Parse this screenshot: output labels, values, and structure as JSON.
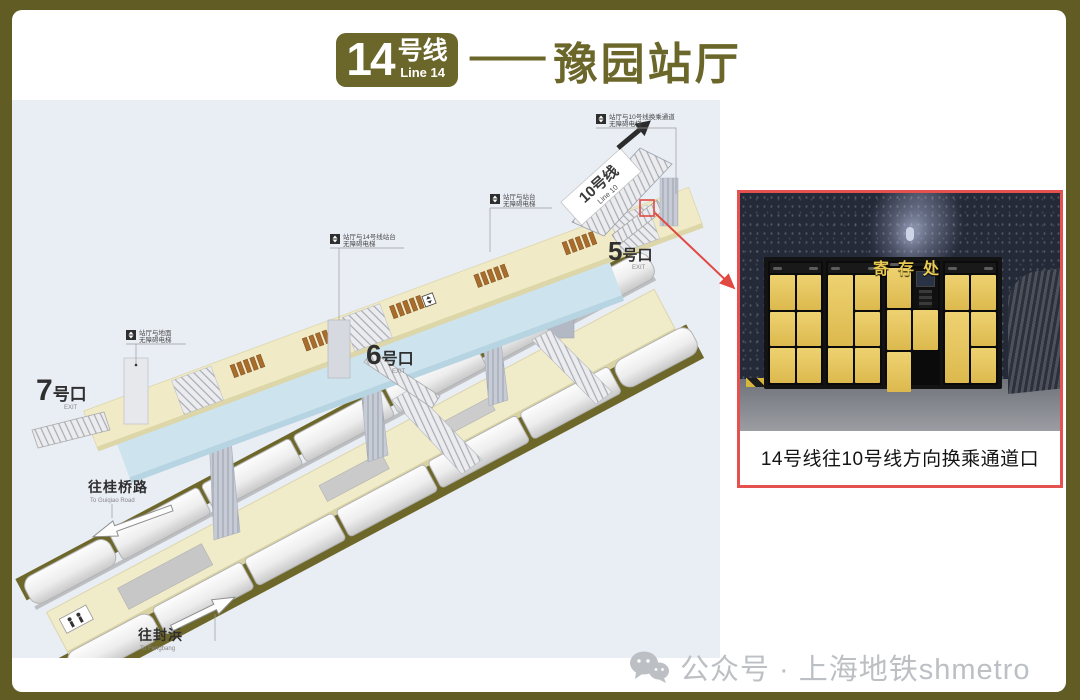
{
  "colors": {
    "frame_olive": "#615c23",
    "accent_olive": "#6b662a",
    "inset_border_red": "#e4514e",
    "diagram_background": "#e9edf4",
    "concourse_beige": "#f0ebc6",
    "hall_floor_blue": "#cde3ee",
    "locker_yellow": "#e3c35c",
    "track_olive": "#6d672a",
    "watermark_gray": "#bcbfc3"
  },
  "header": {
    "badge_num": "14",
    "badge_suffix": "号线",
    "badge_sub": "Line 14",
    "dash": "——",
    "title": "豫园站厅"
  },
  "diagram": {
    "line10_sign": {
      "label": "10号线",
      "sub": "Line 10"
    },
    "exits": [
      {
        "num": "5",
        "suffix": "号口",
        "sub": "EXIT"
      },
      {
        "num": "6",
        "suffix": "号口",
        "sub": "EXIT"
      },
      {
        "num": "7",
        "suffix": "号口",
        "sub": "EXIT"
      }
    ],
    "elevator_labels": [
      {
        "line1": "站厅与10号线换乘通道",
        "line2": "无障碍电梯"
      },
      {
        "line1": "站厅与站台",
        "line2": "无障碍电梯"
      },
      {
        "line1": "站厅与14号线站台",
        "line2": "无障碍电梯"
      },
      {
        "line1": "站厅与地面",
        "line2": "无障碍电梯"
      }
    ],
    "directions": [
      {
        "line1": "往桂桥路",
        "line2": "To Guiqiao Road"
      },
      {
        "line1": "往封浜",
        "line2": "To Fengbang"
      }
    ]
  },
  "inset": {
    "locker_sign": "寄存处",
    "caption": "14号线往10号线方向换乘通道口"
  },
  "watermark": {
    "label": "公众号 · 上海地铁shmetro"
  }
}
